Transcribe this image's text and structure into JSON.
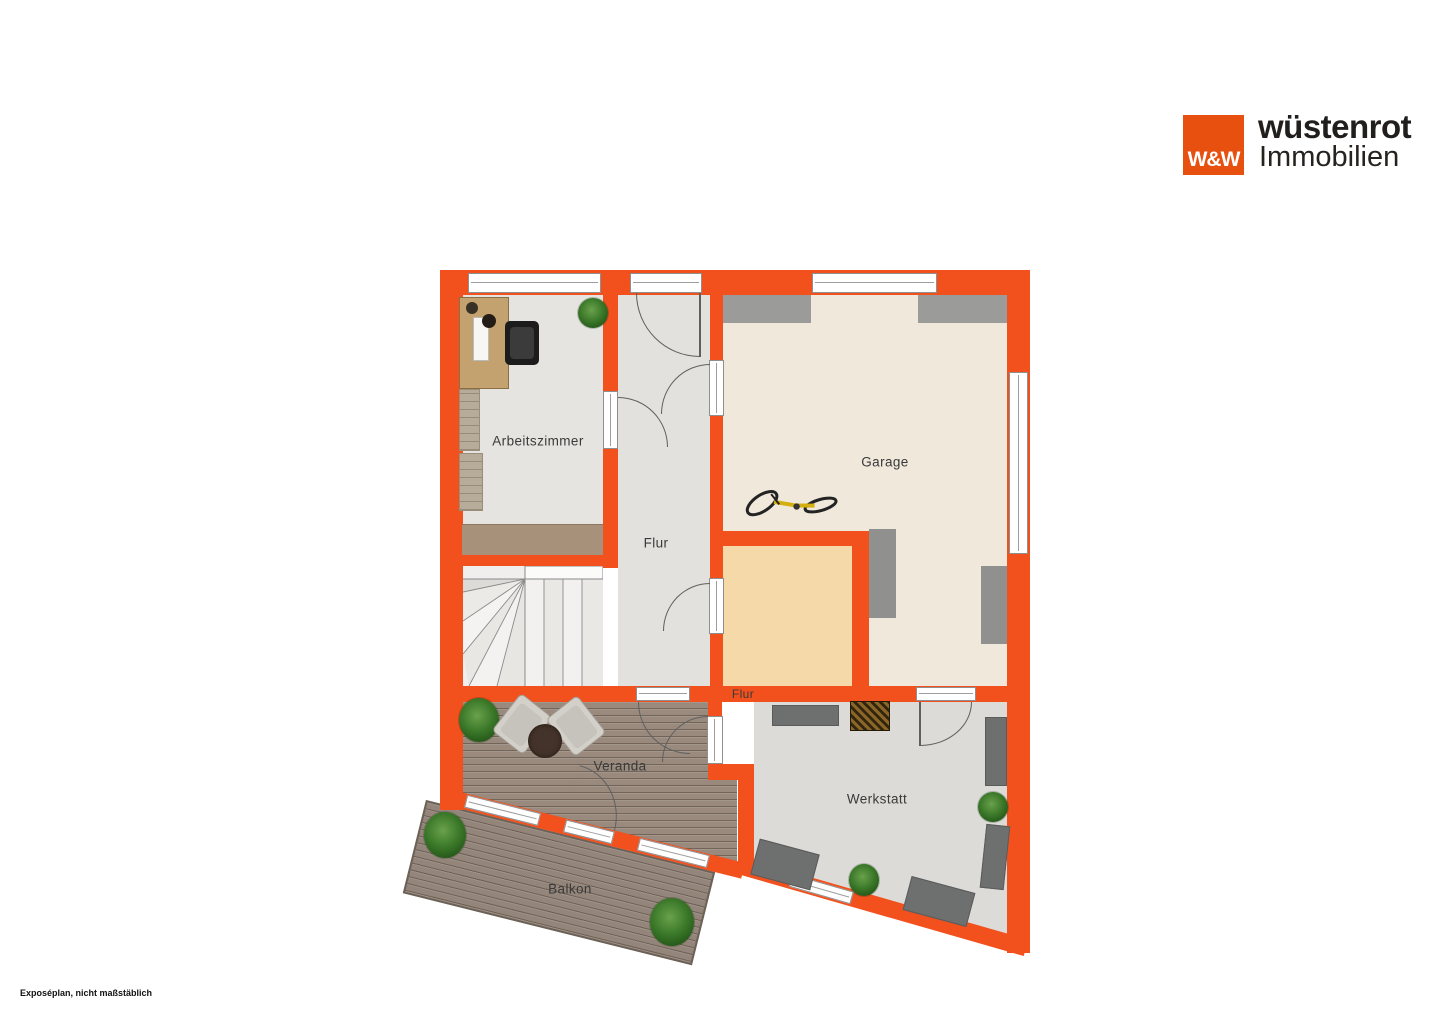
{
  "brand": {
    "logo_monogram": "W&W",
    "name": "wüstenrot",
    "division": "Immobilien",
    "logo_color": "#e8500f"
  },
  "plan": {
    "wall_color": "#f2501d",
    "labels": {
      "arbeitszimmer": "Arbeitszimmer",
      "flur": "Flur",
      "garage": "Garage",
      "flur_klein": "Flur",
      "veranda": "Veranda",
      "werkstatt": "Werkstatt",
      "balkon": "Balkon"
    },
    "floor_colors": {
      "default_room": "#e3e2df",
      "garage": "#efe8db",
      "flur_klein": "#f5d9a9",
      "wood_deck": "#998a7d",
      "werkstatt": "#dcdbd8"
    },
    "symbols": {
      "stairs": "winder-stairs",
      "bicycle": "bicycle",
      "plant": "potted-plant",
      "desk": "desk-with-office-chair",
      "seating": "two-armchairs-with-round-table",
      "workbench": "workbench"
    }
  },
  "footer": {
    "note": "Exposéplan, nicht maßstäblich"
  }
}
